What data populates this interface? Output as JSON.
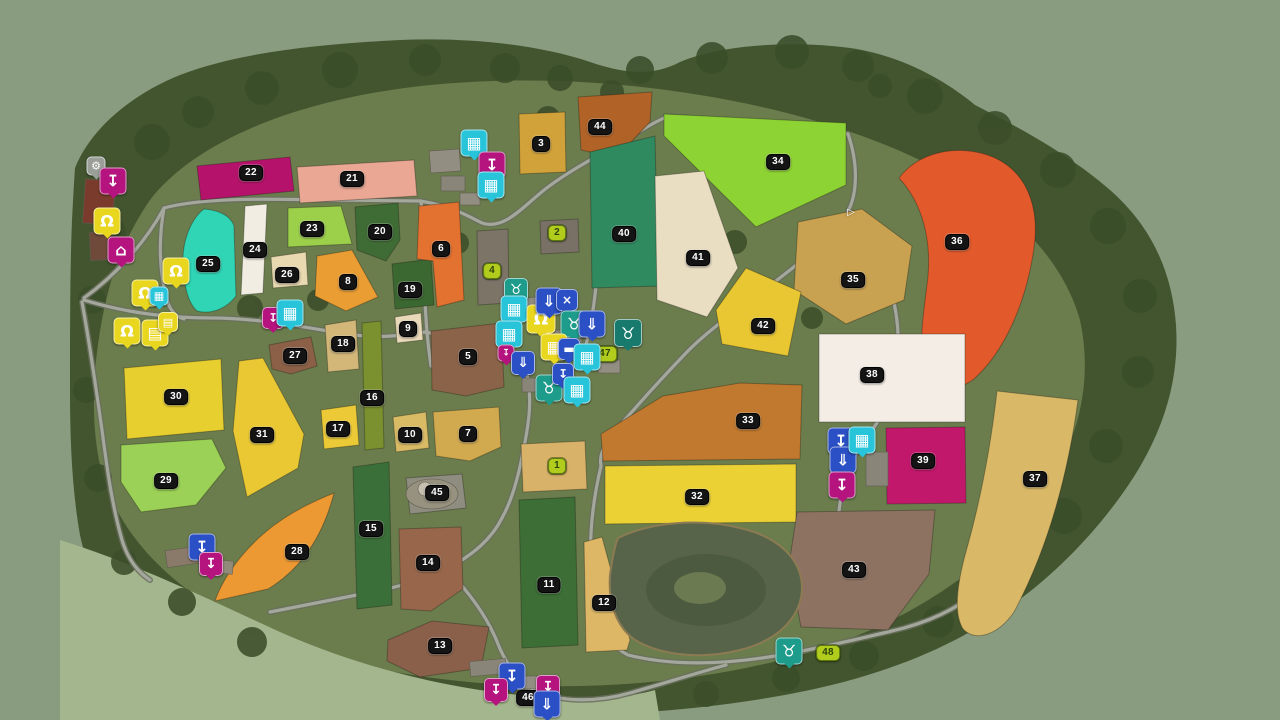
{
  "map": {
    "description": "Farming Simulator style PDA map overview with numbered fields",
    "field_badges": [
      {
        "num": "1",
        "style": "green",
        "x": 557,
        "y": 466
      },
      {
        "num": "2",
        "style": "green",
        "x": 557,
        "y": 233
      },
      {
        "num": "3",
        "style": "black",
        "x": 541,
        "y": 144
      },
      {
        "num": "4",
        "style": "green",
        "x": 492,
        "y": 271
      },
      {
        "num": "5",
        "style": "black",
        "x": 468,
        "y": 357
      },
      {
        "num": "6",
        "style": "black",
        "x": 441,
        "y": 249
      },
      {
        "num": "7",
        "style": "black",
        "x": 468,
        "y": 434
      },
      {
        "num": "8",
        "style": "black",
        "x": 348,
        "y": 282
      },
      {
        "num": "9",
        "style": "black",
        "x": 408,
        "y": 329
      },
      {
        "num": "10",
        "style": "black",
        "x": 410,
        "y": 435
      },
      {
        "num": "11",
        "style": "black",
        "x": 549,
        "y": 585
      },
      {
        "num": "12",
        "style": "black",
        "x": 604,
        "y": 603
      },
      {
        "num": "13",
        "style": "black",
        "x": 440,
        "y": 646
      },
      {
        "num": "14",
        "style": "black",
        "x": 428,
        "y": 563
      },
      {
        "num": "15",
        "style": "black",
        "x": 371,
        "y": 529
      },
      {
        "num": "16",
        "style": "black",
        "x": 372,
        "y": 398
      },
      {
        "num": "17",
        "style": "black",
        "x": 338,
        "y": 429
      },
      {
        "num": "18",
        "style": "black",
        "x": 343,
        "y": 344
      },
      {
        "num": "19",
        "style": "black",
        "x": 410,
        "y": 290
      },
      {
        "num": "20",
        "style": "black",
        "x": 380,
        "y": 232
      },
      {
        "num": "21",
        "style": "black",
        "x": 352,
        "y": 179
      },
      {
        "num": "22",
        "style": "black",
        "x": 251,
        "y": 173
      },
      {
        "num": "23",
        "style": "black",
        "x": 312,
        "y": 229
      },
      {
        "num": "24",
        "style": "black",
        "x": 255,
        "y": 250
      },
      {
        "num": "25",
        "style": "black",
        "x": 208,
        "y": 264
      },
      {
        "num": "26",
        "style": "black",
        "x": 287,
        "y": 275
      },
      {
        "num": "27",
        "style": "black",
        "x": 295,
        "y": 356
      },
      {
        "num": "28",
        "style": "black",
        "x": 297,
        "y": 552
      },
      {
        "num": "29",
        "style": "black",
        "x": 166,
        "y": 481
      },
      {
        "num": "30",
        "style": "black",
        "x": 176,
        "y": 397
      },
      {
        "num": "31",
        "style": "black",
        "x": 262,
        "y": 435
      },
      {
        "num": "32",
        "style": "black",
        "x": 697,
        "y": 497
      },
      {
        "num": "33",
        "style": "black",
        "x": 748,
        "y": 421
      },
      {
        "num": "34",
        "style": "black",
        "x": 778,
        "y": 162
      },
      {
        "num": "35",
        "style": "black",
        "x": 853,
        "y": 280
      },
      {
        "num": "36",
        "style": "black",
        "x": 957,
        "y": 242
      },
      {
        "num": "37",
        "style": "black",
        "x": 1035,
        "y": 479
      },
      {
        "num": "38",
        "style": "black",
        "x": 872,
        "y": 375
      },
      {
        "num": "39",
        "style": "black",
        "x": 923,
        "y": 461
      },
      {
        "num": "40",
        "style": "black",
        "x": 624,
        "y": 234
      },
      {
        "num": "41",
        "style": "black",
        "x": 698,
        "y": 258
      },
      {
        "num": "42",
        "style": "black",
        "x": 763,
        "y": 326
      },
      {
        "num": "43",
        "style": "black",
        "x": 854,
        "y": 570
      },
      {
        "num": "44",
        "style": "black",
        "x": 600,
        "y": 127
      },
      {
        "num": "45",
        "style": "black",
        "x": 437,
        "y": 493
      },
      {
        "num": "46",
        "style": "black",
        "x": 528,
        "y": 698
      },
      {
        "num": "47",
        "style": "green",
        "x": 605,
        "y": 354
      },
      {
        "num": "48",
        "style": "green",
        "x": 828,
        "y": 653
      }
    ],
    "icons": [
      {
        "type": "gear",
        "palette": "gray",
        "x": 96,
        "y": 166,
        "size": 17
      },
      {
        "type": "sell-point",
        "palette": "magenta",
        "x": 113,
        "y": 181
      },
      {
        "type": "person",
        "palette": "yellow",
        "x": 107,
        "y": 221
      },
      {
        "type": "bank",
        "palette": "magenta",
        "x": 121,
        "y": 250
      },
      {
        "type": "person",
        "palette": "yellow",
        "x": 176,
        "y": 271
      },
      {
        "type": "person",
        "palette": "yellow",
        "x": 145,
        "y": 293
      },
      {
        "type": "production",
        "palette": "cyan",
        "x": 159,
        "y": 296,
        "size": 17
      },
      {
        "type": "person",
        "palette": "yellow",
        "x": 127,
        "y": 331
      },
      {
        "type": "document",
        "palette": "yellow",
        "x": 155,
        "y": 333
      },
      {
        "type": "document",
        "palette": "yellow",
        "x": 168,
        "y": 322,
        "size": 18
      },
      {
        "type": "production",
        "palette": "cyan",
        "x": 474,
        "y": 143
      },
      {
        "type": "sell-point",
        "palette": "magenta",
        "x": 492,
        "y": 165
      },
      {
        "type": "production",
        "palette": "cyan",
        "x": 491,
        "y": 185
      },
      {
        "type": "sell-point",
        "palette": "magenta",
        "x": 273,
        "y": 318,
        "size": 20
      },
      {
        "type": "production",
        "palette": "cyan",
        "x": 290,
        "y": 313
      },
      {
        "type": "animal-sheep",
        "palette": "teal",
        "x": 516,
        "y": 290,
        "size": 22
      },
      {
        "type": "production",
        "palette": "cyan",
        "x": 514,
        "y": 309
      },
      {
        "type": "person",
        "palette": "yellow",
        "x": 541,
        "y": 319,
        "size": 27
      },
      {
        "type": "production",
        "palette": "cyan",
        "x": 509,
        "y": 334
      },
      {
        "type": "hopper",
        "palette": "blue",
        "x": 549,
        "y": 301
      },
      {
        "type": "mill",
        "palette": "blue",
        "x": 567,
        "y": 300,
        "size": 20
      },
      {
        "type": "animal-sheep",
        "palette": "teal",
        "x": 574,
        "y": 324
      },
      {
        "type": "container",
        "palette": "blue",
        "x": 592,
        "y": 324
      },
      {
        "type": "animal-pig",
        "palette": "darkteal",
        "x": 628,
        "y": 333,
        "size": 26
      },
      {
        "type": "market",
        "palette": "yellow",
        "x": 554,
        "y": 347
      },
      {
        "type": "sign",
        "palette": "blue",
        "x": 569,
        "y": 349,
        "size": 20
      },
      {
        "type": "sell-point",
        "palette": "magenta",
        "x": 506,
        "y": 353,
        "size": 15
      },
      {
        "type": "hopper",
        "palette": "blue",
        "x": 523,
        "y": 363,
        "size": 22
      },
      {
        "type": "production",
        "palette": "cyan",
        "x": 587,
        "y": 357
      },
      {
        "type": "animal-cow",
        "palette": "teal",
        "x": 549,
        "y": 388
      },
      {
        "type": "sell-point",
        "palette": "blue",
        "x": 563,
        "y": 374,
        "size": 20
      },
      {
        "type": "production",
        "palette": "cyan",
        "x": 577,
        "y": 390
      },
      {
        "type": "sell-point",
        "palette": "blue",
        "x": 841,
        "y": 441
      },
      {
        "type": "container",
        "palette": "blue",
        "x": 843,
        "y": 460
      },
      {
        "type": "production",
        "palette": "cyan",
        "x": 862,
        "y": 440
      },
      {
        "type": "sell-point",
        "palette": "magenta",
        "x": 842,
        "y": 485
      },
      {
        "type": "sell-point",
        "palette": "blue",
        "x": 202,
        "y": 547
      },
      {
        "type": "sell-point",
        "palette": "magenta",
        "x": 211,
        "y": 564,
        "size": 22
      },
      {
        "type": "sell-point",
        "palette": "blue",
        "x": 512,
        "y": 676
      },
      {
        "type": "sell-point",
        "palette": "magenta",
        "x": 496,
        "y": 690,
        "size": 22
      },
      {
        "type": "sell-point",
        "palette": "magenta",
        "x": 548,
        "y": 687,
        "size": 22
      },
      {
        "type": "container",
        "palette": "blue",
        "x": 547,
        "y": 704
      },
      {
        "type": "animal-goat",
        "palette": "teal",
        "x": 789,
        "y": 651
      },
      {
        "type": "map-arrow",
        "palette": "none",
        "x": 851,
        "y": 212,
        "size": 16
      }
    ]
  },
  "icon_palette": {
    "magenta": "#b5137e",
    "blue": "#2b4fc4",
    "cyan": "#27c4da",
    "teal": "#1d9c8c",
    "darkteal": "#177a6c",
    "yellow": "#e9d61f",
    "gray": "#9aa098",
    "none": "transparent"
  },
  "icon_glyphs": {
    "gear": "⚙",
    "sell-point": "↧",
    "production": "▦",
    "person": "Ω",
    "bank": "⌂",
    "document": "▤",
    "market": "▦",
    "container": "⇓",
    "hopper": "⇓",
    "mill": "×",
    "sign": "▬",
    "animal-sheep": "♉",
    "animal-cow": "♉",
    "animal-pig": "♉",
    "animal-goat": "♉",
    "map-arrow": "▷"
  },
  "badge_colors": {
    "black_bg": "#141414",
    "black_text": "#ffffff",
    "green_bg": "#b2cc1e",
    "green_text": "#2c4408"
  }
}
